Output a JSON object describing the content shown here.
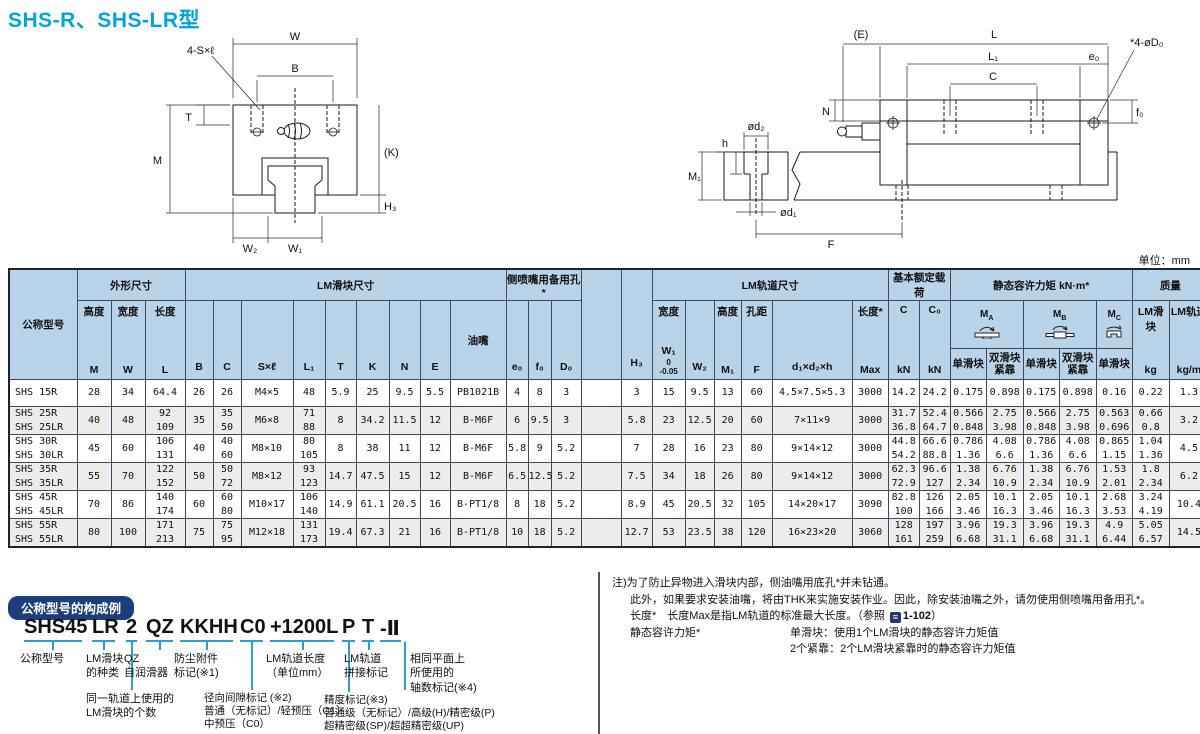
{
  "page": {
    "title": "SHS-R、SHS-LR型",
    "unit_label": "单位：mm"
  },
  "colors": {
    "title": "#00a5d8",
    "table_header_bg": "#b9d3e9",
    "row_alt_bg": "#ececec",
    "badge_bg": "#1c3f7b",
    "connector_blue": "#2f9cd6"
  },
  "diagram_front": {
    "labels": {
      "w": "W",
      "b": "B",
      "s": "4-S×ℓ",
      "t": "T",
      "m": "M",
      "k": "(K)",
      "h3": "H₃",
      "w2": "W₂",
      "w1": "W₁"
    }
  },
  "diagram_side": {
    "labels": {
      "e": "(E)",
      "l": "L",
      "l1": "L₁",
      "e0": "e₀",
      "c": "C",
      "d0": "*4-øD₀",
      "f0": "f₀",
      "n": "N",
      "d2": "ød₂",
      "h": "h",
      "m1": "M₁",
      "d1": "ød₁",
      "f": "F"
    }
  },
  "table": {
    "head": {
      "model": "公称型号",
      "groups": {
        "outer": "外形尺寸",
        "block": "LM滑块尺寸",
        "side_hole": "侧喷嘴用备用孔*",
        "rail": "LM轨道尺寸",
        "load": "基本额定载荷",
        "moment": "静态容许力矩 kN·m*",
        "mass": "质量"
      },
      "h3": "H₃",
      "sub": {
        "height": "高度",
        "m": "M",
        "width": "宽度",
        "w": "W",
        "length": "长度",
        "l": "L",
        "b": "B",
        "c": "C",
        "sxl": "S×ℓ",
        "l1": "L₁",
        "t": "T",
        "k": "K",
        "n": "N",
        "e": "E",
        "nipple": "油嘴",
        "e0": "e₀",
        "f0": "f₀",
        "d0": "D₀",
        "w1_top": "宽度",
        "w1": "W₁",
        "w1_tol": "0\n-0.05",
        "w2": "W₂",
        "m1_top": "高度",
        "m1": "M₁",
        "f_top": "孔距",
        "f": "F",
        "d1d2h": "d₁×d₂×h",
        "max_top": "长度*",
        "max": "Max",
        "c_sym": "C",
        "c0_sym": "C₀",
        "kn": "kN",
        "m_main": "M",
        "ma_sub": "A",
        "mb_sub": "B",
        "mc_sub": "C",
        "single": "单滑块",
        "double": "双滑块\n紧靠",
        "mass_block": "LM滑块",
        "mass_rail": "LM轨道",
        "kg": "kg",
        "kgm": "kg/m"
      }
    },
    "rows": [
      [
        "SHS 15R",
        "28",
        "34",
        "64.4",
        "26",
        "26",
        "M4×5",
        "48",
        "5.9",
        "25",
        "9.5",
        "5.5",
        "PB1021B",
        "4",
        "8",
        "3",
        "",
        "3",
        "15",
        "9.5",
        "13",
        "60",
        "4.5×7.5×5.3",
        "3000",
        "14.2",
        "24.2",
        "0.175",
        "0.898",
        "0.175",
        "0.898",
        "0.16",
        "0.22",
        "1.3"
      ],
      [
        "SHS 25R\nSHS 25LR",
        "40",
        "48",
        "92\n109",
        "35",
        "35\n50",
        "M6×8",
        "71\n88",
        "8",
        "34.2",
        "11.5",
        "12",
        "B-M6F",
        "6",
        "9.5",
        "3",
        "",
        "5.8",
        "23",
        "12.5",
        "20",
        "60",
        "7×11×9",
        "3000",
        "31.7\n36.8",
        "52.4\n64.7",
        "0.566\n0.848",
        "2.75\n3.98",
        "0.566\n0.848",
        "2.75\n3.98",
        "0.563\n0.696",
        "0.66\n0.8",
        "3.2"
      ],
      [
        "SHS 30R\nSHS 30LR",
        "45",
        "60",
        "106\n131",
        "40",
        "40\n60",
        "M8×10",
        "80\n105",
        "8",
        "38",
        "11",
        "12",
        "B-M6F",
        "5.8",
        "9",
        "5.2",
        "",
        "7",
        "28",
        "16",
        "23",
        "80",
        "9×14×12",
        "3000",
        "44.8\n54.2",
        "66.6\n88.8",
        "0.786\n1.36",
        "4.08\n6.6",
        "0.786\n1.36",
        "4.08\n6.6",
        "0.865\n1.15",
        "1.04\n1.36",
        "4.5"
      ],
      [
        "SHS 35R\nSHS 35LR",
        "55",
        "70",
        "122\n152",
        "50",
        "50\n72",
        "M8×12",
        "93\n123",
        "14.7",
        "47.5",
        "15",
        "12",
        "B-M6F",
        "6.5",
        "12.5",
        "5.2",
        "",
        "7.5",
        "34",
        "18",
        "26",
        "80",
        "9×14×12",
        "3000",
        "62.3\n72.9",
        "96.6\n127",
        "1.38\n2.34",
        "6.76\n10.9",
        "1.38\n2.34",
        "6.76\n10.9",
        "1.53\n2.01",
        "1.8\n2.34",
        "6.2"
      ],
      [
        "SHS 45R\nSHS 45LR",
        "70",
        "86",
        "140\n174",
        "60",
        "60\n80",
        "M10×17",
        "106\n140",
        "14.9",
        "61.1",
        "20.5",
        "16",
        "B-PT1/8",
        "8",
        "18",
        "5.2",
        "",
        "8.9",
        "45",
        "20.5",
        "32",
        "105",
        "14×20×17",
        "3090",
        "82.8\n100",
        "126\n166",
        "2.05\n3.46",
        "10.1\n16.3",
        "2.05\n3.46",
        "10.1\n16.3",
        "2.68\n3.53",
        "3.24\n4.19",
        "10.4"
      ],
      [
        "SHS 55R\nSHS 55LR",
        "80",
        "100",
        "171\n213",
        "75",
        "75\n95",
        "M12×18",
        "131\n173",
        "19.4",
        "67.3",
        "21",
        "16",
        "B-PT1/8",
        "10",
        "18",
        "5.2",
        "",
        "12.7",
        "53",
        "23.5",
        "38",
        "120",
        "16×23×20",
        "3060",
        "128\n161",
        "197\n259",
        "3.96\n6.68",
        "19.3\n31.1",
        "3.96\n6.68",
        "19.3\n31.1",
        "4.9\n6.44",
        "5.05\n6.57",
        "14.5"
      ]
    ]
  },
  "notes": {
    "line1": "注)为了防止异物进入滑块内部，侧油嘴用底孔*并未钻通。",
    "line2": "此外，如果要求安装油嘴，将由THK来实施安装作业。因此，除安装油嘴之外，请勿使用侧喷嘴用备用孔*。",
    "line3_pre": "长度*　长度Max是指LM轨道的标准最大长度。（参照 ",
    "line3_ref": "1-102",
    "line3_post": "）",
    "line4_label": "静态容许力矩*",
    "line4_text": "单滑块：使用1个LM滑块的静态容许力矩值",
    "line5_text": "2个紧靠：2个LM滑块紧靠时的静态容许力矩值"
  },
  "formation": {
    "badge": "公称型号的构成例",
    "parts": [
      "SHS45",
      "LR",
      "2",
      "QZ",
      "KKHH",
      "C0",
      "+1200L",
      "P",
      "T",
      "-Ⅱ"
    ],
    "labels": {
      "model": "公称型号",
      "block_type": "LM滑块\n的种类",
      "qz": "QZ\n自润滑器",
      "dust": "防尘附件\n标记(※1)",
      "rail_length": "LM轨道长度\n（单位mm）",
      "joint": "LM轨道\n拼接标记",
      "axes": "相同平面上\n所使用的\n轴数标记(※4)",
      "block_count": "同一轨道上使用的\nLM滑块的个数",
      "clearance": "径向间隙标记 (※2)\n普通（无标记）/轻预压（C1）\n中预压（C0）",
      "accuracy": "精度标记(※3)\n普通级（无标记）/高级(H)/精密级(P)\n超精密级(SP)/超超精密级(UP)"
    }
  }
}
